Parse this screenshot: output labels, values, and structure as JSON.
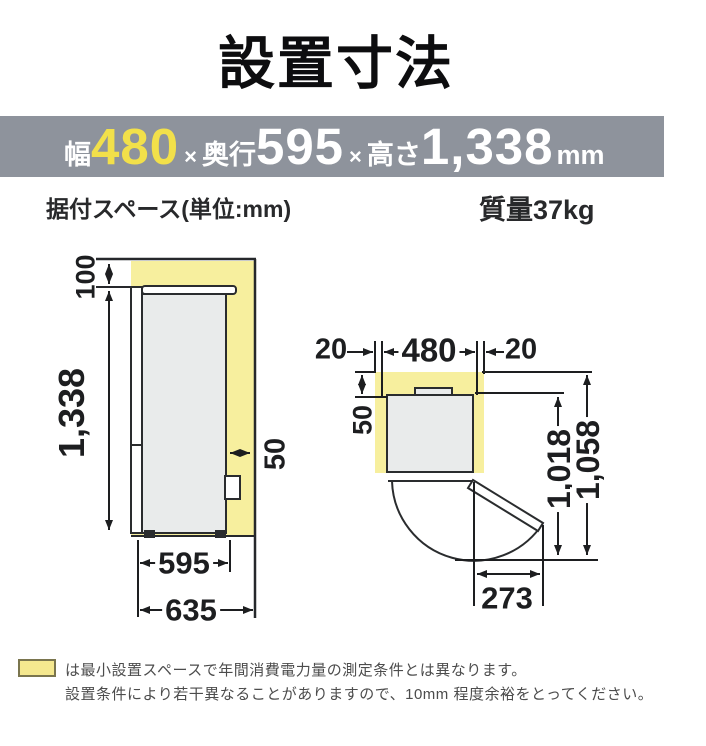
{
  "title": "設置寸法",
  "spec_bar": {
    "width_label": "幅",
    "width_value": "480",
    "sep1": "×",
    "depth_label": "奥行",
    "depth_value": "595",
    "sep2": "×",
    "height_label": "高さ",
    "height_value": "1,338",
    "unit": "mm"
  },
  "subheader": {
    "space_label": "据付スペース(単位:mm)",
    "weight_label": "質量",
    "weight_value": "37kg"
  },
  "side_view": {
    "top_clearance": "100",
    "height": "1,338",
    "rear_clearance": "50",
    "depth": "595",
    "total_depth": "635"
  },
  "top_view": {
    "left_clearance": "20",
    "width": "480",
    "right_clearance": "20",
    "rear_clearance": "50",
    "door_open_depth": "1,018",
    "total_depth": "1,058",
    "door_swing_width": "273"
  },
  "note": {
    "line1": "は最小設置スペースで年間消費電力量の測定条件とは異なります。",
    "line2": "設置条件により若干異なることがありますので、10mm 程度余裕をとってください。"
  },
  "colors": {
    "bar_gray": "#8e939c",
    "accent_yellow": "#f2e04a",
    "space_yellow": "#f7ef9e",
    "fridge_gray": "#e9ebeb",
    "line_dark": "#1d1e20"
  }
}
